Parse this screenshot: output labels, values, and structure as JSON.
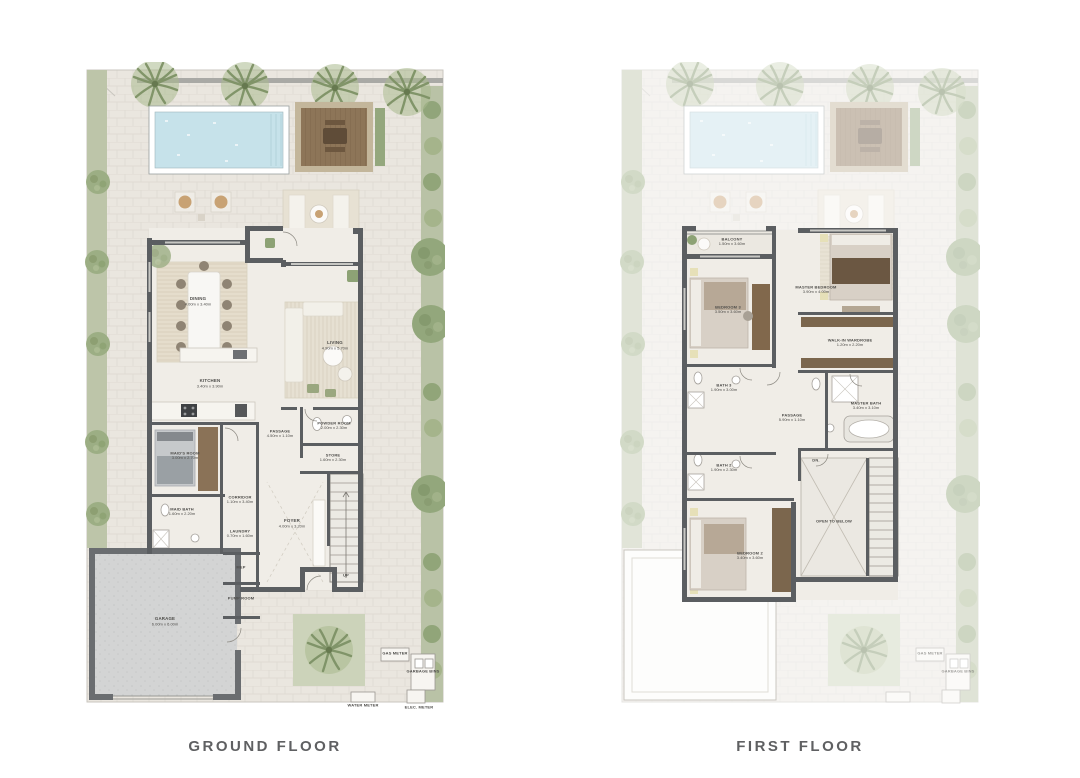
{
  "document": {
    "type": "villa floor plan sheet",
    "background": "#ffffff"
  },
  "plans": {
    "ground": {
      "title": "GROUND FLOOR",
      "rooms": [
        {
          "name": "DINING",
          "dims": "4.00m x 3.40m"
        },
        {
          "name": "LIVING",
          "dims": "4.90m x 5.70m"
        },
        {
          "name": "KITCHEN",
          "dims": "3.40m x 3.90m"
        },
        {
          "name": "POWDER ROOM",
          "dims": "2.00m x 2.30m"
        },
        {
          "name": "PASSAGE",
          "dims": "4.50m x 1.10m"
        },
        {
          "name": "STORE",
          "dims": "1.60m x 2.30m"
        },
        {
          "name": "MAID'S ROOM",
          "dims": "3.00m x 2.70m"
        },
        {
          "name": "MAID BATH",
          "dims": "1.60m x 2.20m"
        },
        {
          "name": "CORRIDOR",
          "dims": "1.10m x 3.40m"
        },
        {
          "name": "LAUNDRY",
          "dims": "0.70m x 1.60m"
        },
        {
          "name": "FOYER",
          "dims": "4.00m x 3.20m"
        },
        {
          "name": "MEP",
          "dims": ""
        },
        {
          "name": "PUMP ROOM",
          "dims": ""
        },
        {
          "name": "GARAGE",
          "dims": "6.00m x 6.00m"
        }
      ],
      "stair_label": "UP",
      "meters": [
        {
          "label": "GAS METER"
        },
        {
          "label": "GARBAGE BINS"
        },
        {
          "label": "WATER METER"
        },
        {
          "label": "ELEC. METER"
        }
      ]
    },
    "first": {
      "title": "FIRST FLOOR",
      "rooms": [
        {
          "name": "BALCONY",
          "dims": "1.50m x 3.60m"
        },
        {
          "name": "BEDROOM 3",
          "dims": "3.50m x 3.60m"
        },
        {
          "name": "MASTER BEDROOM",
          "dims": "3.90m x 4.00m"
        },
        {
          "name": "WALK-IN WARDROBE",
          "dims": "1.20m x 2.20m"
        },
        {
          "name": "BATH 3",
          "dims": "1.90m x 3.00m"
        },
        {
          "name": "MASTER BATH",
          "dims": "3.40m x 3.10m"
        },
        {
          "name": "PASSAGE",
          "dims": "5.90m x 1.10m"
        },
        {
          "name": "BATH 2",
          "dims": "1.90m x 2.30m"
        },
        {
          "name": "BEDROOM 2",
          "dims": "3.40m x 3.60m"
        },
        {
          "name": "OPEN TO BELOW",
          "dims": ""
        }
      ],
      "stair_label": "DN."
    }
  },
  "colors": {
    "wall": "#5b5e61",
    "paving": "#eae6df",
    "landscape_strip": "#bdc5a9",
    "tree": "#9cae84",
    "pool_water": "#c6e2ea",
    "deck_wood": "#8d7558",
    "garage_floor": "#d3d4d4",
    "interior_floor": "#f0ede7",
    "wardrobe_wood": "#7b664d",
    "title_text": "#5f6062"
  }
}
